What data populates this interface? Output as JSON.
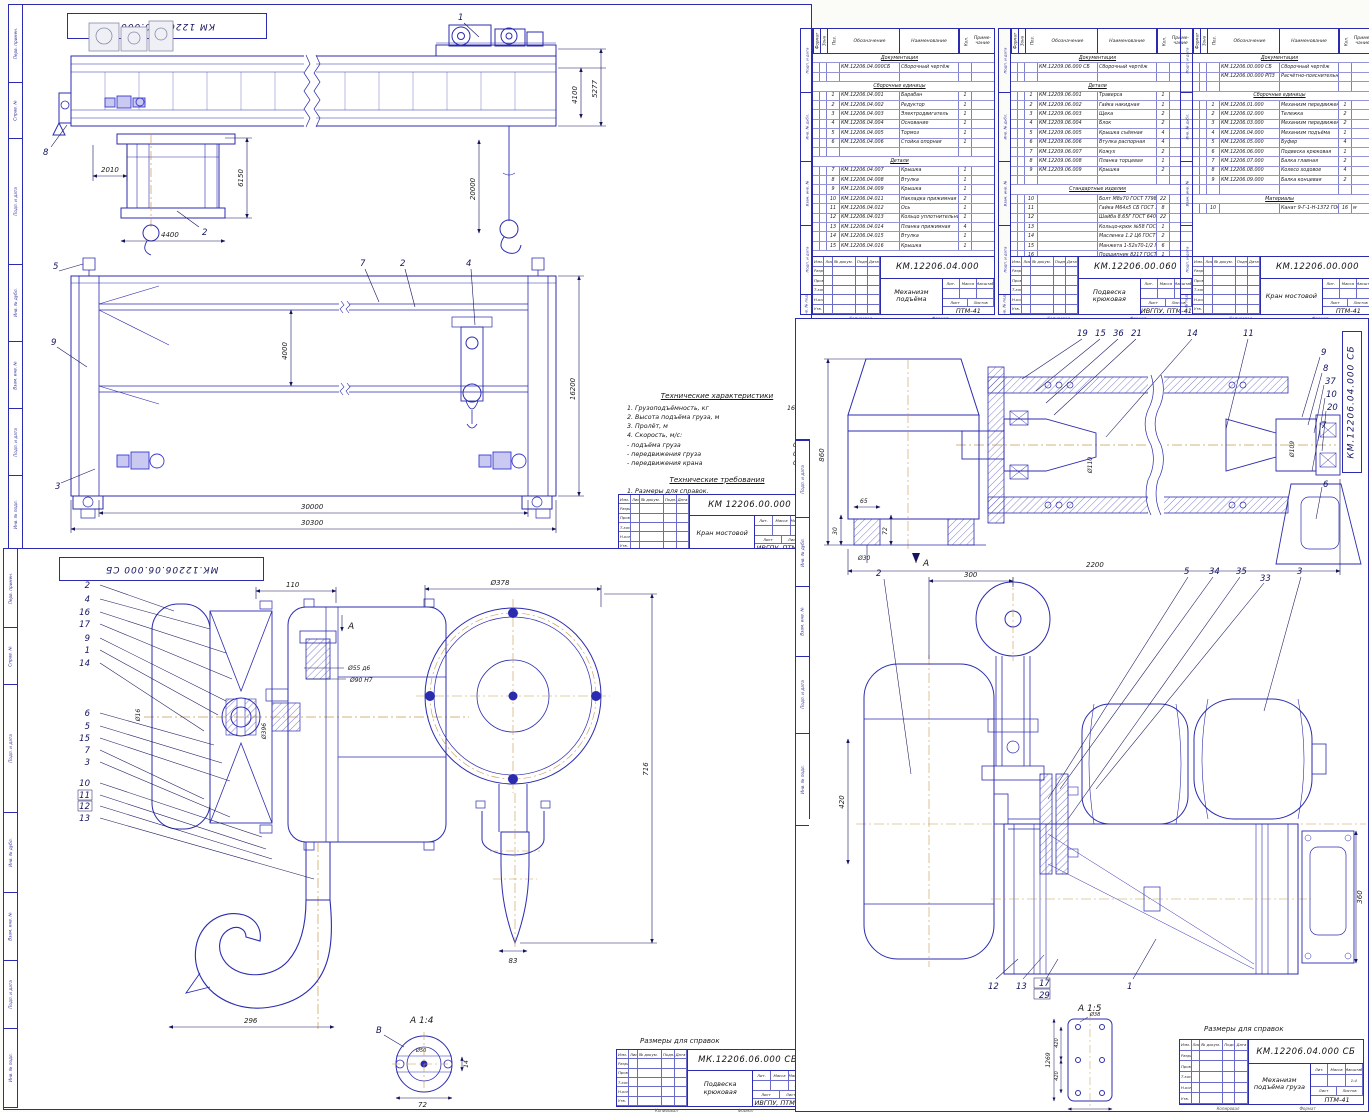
{
  "colors": {
    "line": "#2b2bb0",
    "center": "#c89a4e",
    "dark_text": "#1b1b1b",
    "machinery": "#3a3ad0"
  },
  "tb": {
    "rows": [
      "Изм.",
      "Лист",
      "№ докум.",
      "Подп.",
      "Дата"
    ],
    "sign": [
      "Разраб.",
      "Пров.",
      "Т.контр.",
      "Н.контр.",
      "Утв."
    ],
    "lit": "Лит.",
    "mass": "Масса",
    "scale_l": "Масштаб",
    "sheet": "Лист",
    "sheets": "Листов",
    "copied": "Копировал",
    "format": "Формат"
  },
  "side_labels": [
    "Перв. примен.",
    "Справ. №",
    "Подп. и дата",
    "Инв. № дубл.",
    "Взам. инв. №",
    "Подп. и дата",
    "Инв. № подл."
  ],
  "title_blocks": [
    {
      "doc": "КМ 12206.00.000",
      "name": "Кран мостовой",
      "org": "ИВГПУ, ПТМ-41",
      "scale": ""
    },
    {
      "doc": "МК.12206.06.000 СБ",
      "name": "Подвеска крюковая",
      "org": "ИВГПУ, ПТМ-41",
      "scale": "1:2"
    },
    {
      "doc": "КМ.12206.04.000 СБ",
      "name": "Механизм подъёма груза",
      "org": "ПТМ-41",
      "scale": "1:4"
    },
    {
      "doc": "КМ.12206.04.000",
      "name": "Механизм подъёма",
      "org": "ПТМ-41",
      "scale": ""
    },
    {
      "doc": "КМ.12206.00.060",
      "name": "Подвеска крюковая",
      "org": "ИВГПУ, ПТМ-41",
      "scale": ""
    },
    {
      "doc": "КМ.12206.00.000",
      "name": "Кран мостовой",
      "org": "ПТМ-41",
      "scale": ""
    }
  ],
  "spec": {
    "headers": {
      "f": "Формат",
      "z": "Зона",
      "p": "Поз.",
      "o": "Обозначение",
      "n": "Наименование",
      "q": "Кол.",
      "note": "Приме- чание"
    },
    "tables": [
      {
        "rows": [
          {
            "sec": "Документация"
          },
          {
            "o": "КМ.12206.04.000СБ",
            "n": "Сборочный чертёж"
          },
          {},
          {
            "sec": "Сборочные единицы"
          },
          {
            "p": "1",
            "o": "КМ.12206.04.001",
            "n": "Барабан",
            "q": "1"
          },
          {
            "p": "2",
            "o": "КМ.12206.04.002",
            "n": "Редуктор",
            "q": "1"
          },
          {
            "p": "3",
            "o": "КМ.12206.04.003",
            "n": "Электродвигатель",
            "q": "1"
          },
          {
            "p": "4",
            "o": "КМ.12206.04.004",
            "n": "Основание",
            "q": "1"
          },
          {
            "p": "5",
            "o": "КМ.12206.04.005",
            "n": "Тормоз",
            "q": "1"
          },
          {
            "p": "6",
            "o": "КМ.12206.04.006",
            "n": "Стойка опорная",
            "q": "1"
          },
          {},
          {
            "sec": "Детали"
          },
          {
            "p": "7",
            "o": "КМ.12206.04.007",
            "n": "Крышка",
            "q": "1"
          },
          {
            "p": "8",
            "o": "КМ.12206.04.008",
            "n": "Втулка",
            "q": "1"
          },
          {
            "p": "9",
            "o": "КМ.12206.04.009",
            "n": "Крышка",
            "q": "1"
          },
          {
            "p": "10",
            "o": "КМ.12206.04.011",
            "n": "Накладка прижимная",
            "q": "2"
          },
          {
            "p": "11",
            "o": "КМ.12206.04.012",
            "n": "Ось",
            "q": "1"
          },
          {
            "p": "12",
            "o": "КМ.12206.04.013",
            "n": "Кольцо уплотнительное",
            "q": "1"
          },
          {
            "p": "13",
            "o": "КМ.12206.04.014",
            "n": "Планка прижимная",
            "q": "4"
          },
          {
            "p": "14",
            "o": "КМ.12206.04.015",
            "n": "Втулка",
            "q": "1"
          },
          {
            "p": "15",
            "o": "КМ.12206.04.016",
            "n": "Крышка",
            "q": "1"
          }
        ]
      },
      {
        "rows": [
          {
            "sec": "Документация"
          },
          {
            "o": "КМ.12209.06.000 СБ",
            "n": "Сборочный чертёж"
          },
          {},
          {
            "sec": "Детали"
          },
          {
            "p": "1",
            "o": "КМ.12209.06.001",
            "n": "Траверса",
            "q": "1"
          },
          {
            "p": "2",
            "o": "КМ.12209.06.002",
            "n": "Гайка накидная",
            "q": "1"
          },
          {
            "p": "3",
            "o": "КМ.12209.06.003",
            "n": "Щека",
            "q": "2"
          },
          {
            "p": "4",
            "o": "КМ.12209.06.004",
            "n": "Блок",
            "q": "2"
          },
          {
            "p": "5",
            "o": "КМ.12209.06.005",
            "n": "Крышка съёмная",
            "q": "4"
          },
          {
            "p": "6",
            "o": "КМ.12209.06.006",
            "n": "Втулка распорная",
            "q": "4"
          },
          {
            "p": "7",
            "o": "КМ.12209.06.007",
            "n": "Кожух",
            "q": "2"
          },
          {
            "p": "8",
            "o": "КМ.12209.06.008",
            "n": "Планка торцевая",
            "q": "1"
          },
          {
            "p": "9",
            "o": "КМ.12209.06.009",
            "n": "Крышка",
            "q": "2"
          },
          {},
          {
            "sec": "Стандартные изделия"
          },
          {
            "p": "10",
            "n": "Болт М8х70 ГОСТ 7798-70",
            "q": "22"
          },
          {
            "p": "11",
            "n": "Гайка М64х5 СБ ГОСТ 3915-76",
            "q": "8"
          },
          {
            "p": "12",
            "n": "Шайба 8.65Г ГОСТ 6402-70",
            "q": "22"
          },
          {
            "p": "13",
            "n": "Кольцо-крюк №58 ГОСТ 6627-74",
            "q": "1"
          },
          {
            "p": "14",
            "n": "Масленка 1.2 Ц6 ГОСТ 19853-74",
            "q": "2"
          },
          {
            "p": "15",
            "n": "Манжета 1-52х70-1/2 ГОСТ 8752-79",
            "q": "6"
          },
          {
            "p": "16",
            "n": "Подшипник 8217 ГОСТ 6874-75",
            "q": "1"
          },
          {
            "p": "17",
            "n": "Подшипник 170 ГОСТ 8338-75",
            "q": "4"
          }
        ]
      },
      {
        "rows": [
          {
            "sec": "Документация"
          },
          {
            "o": "КМ.12206.00.000 СБ",
            "n": "Сборочный чертёж"
          },
          {
            "o": "КМ.12206.00.000 РПЗ",
            "n": "Расчётно-пояснительная записка"
          },
          {},
          {
            "sec": "Сборочные единицы"
          },
          {
            "p": "1",
            "o": "КМ.12206.01.000",
            "n": "Механизм передвижения тележки",
            "q": "1"
          },
          {
            "p": "2",
            "o": "КМ.12206.02.000",
            "n": "Тележка",
            "q": "2"
          },
          {
            "p": "3",
            "o": "КМ.12206.03.000",
            "n": "Механизм передвижения крана",
            "q": "2"
          },
          {
            "p": "4",
            "o": "КМ.12206.04.000",
            "n": "Механизм подъёма",
            "q": "1"
          },
          {
            "p": "5",
            "o": "КМ.12206.05.000",
            "n": "Буфер",
            "q": "4"
          },
          {
            "p": "6",
            "o": "КМ.12206.06.000",
            "n": "Подвеска крюковая",
            "q": "1"
          },
          {
            "p": "7",
            "o": "КМ.12206.07.000",
            "n": "Балка главная",
            "q": "2"
          },
          {
            "p": "8",
            "o": "КМ.12206.08.000",
            "n": "Колесо ходовое",
            "q": "4"
          },
          {
            "p": "9",
            "o": "КМ.12206.09.000",
            "n": "Балка концевая",
            "q": "2"
          },
          {},
          {
            "sec": "Материалы"
          },
          {
            "p": "10",
            "n": "Канат 9-Г-1-Н-1372 ГОСТ 7668-80",
            "q": "16",
            "note": "м"
          }
        ]
      }
    ]
  },
  "s1": {
    "stamp": "КМ 12206.00.000",
    "tv": {
      "callouts": [
        "1",
        "8",
        "2"
      ],
      "dims": [
        "2010",
        "6150",
        "4400",
        "4100",
        "5277",
        "20000"
      ]
    },
    "fv": {
      "callouts": [
        "5",
        "9",
        "3",
        "7",
        "2",
        "4"
      ],
      "dims": [
        "4000",
        "16200",
        "30000",
        "30300"
      ]
    },
    "tech": {
      "header": "Технические характеристики",
      "lines": [
        [
          "1. Грузоподъёмность, кг",
          "16000"
        ],
        [
          "2. Высота подъёма груза, м",
          "20"
        ],
        [
          "3. Пролёт, м",
          "30"
        ],
        [
          "4. Скорость, м/с:",
          ""
        ],
        [
          "    - подъёма груза",
          "0,10"
        ],
        [
          "    - передвижения груза",
          "0,32"
        ],
        [
          "    - передвижения крана",
          "0,40"
        ]
      ],
      "req_header": "Технические требования",
      "req_line": "1. Размеры для справок."
    }
  },
  "s3": {
    "stamp": "МК.12206.06.000 СБ",
    "c1": [
      "2",
      "4",
      "16",
      "17",
      "9",
      "1",
      "14"
    ],
    "c2": [
      "6",
      "5",
      "15",
      "7",
      "3"
    ],
    "c3": [
      "10",
      "11",
      "12",
      "13"
    ],
    "dims": [
      "110",
      "Ø55 д6",
      "Ø90 Н7",
      "Ø16",
      "Ø396",
      "296"
    ],
    "fvdims": [
      "Ø378",
      "716",
      "83"
    ],
    "marker": "А",
    "det": {
      "t": "А 1:4",
      "b": "В",
      "dims": [
        "Ø50",
        "72",
        "14"
      ]
    },
    "note": "Размеры для справок"
  },
  "s4": {
    "stamp": "КМ.12206.04.000 СБ",
    "drum": {
      "co": [
        "19",
        "15",
        "36",
        "21",
        "14",
        "11"
      ],
      "co2": [
        "9",
        "8",
        "37",
        "10",
        "20",
        "7",
        "6"
      ],
      "dims": [
        "860",
        "65",
        "30",
        "72",
        "Ø30",
        "2200"
      ],
      "dia": [
        "Ø110",
        "Ø109"
      ],
      "marker": "А"
    },
    "plan": {
      "co": [
        "2",
        "5",
        "34",
        "35",
        "33",
        "3"
      ],
      "co2": [
        "12",
        "13",
        "17",
        "29",
        "1"
      ],
      "dims": [
        "300",
        "420",
        "360"
      ]
    },
    "det": {
      "t": "А 1:5",
      "dims": [
        "1269",
        "420",
        "420",
        "Ø38",
        "480"
      ]
    },
    "note": "Размеры для справок"
  }
}
